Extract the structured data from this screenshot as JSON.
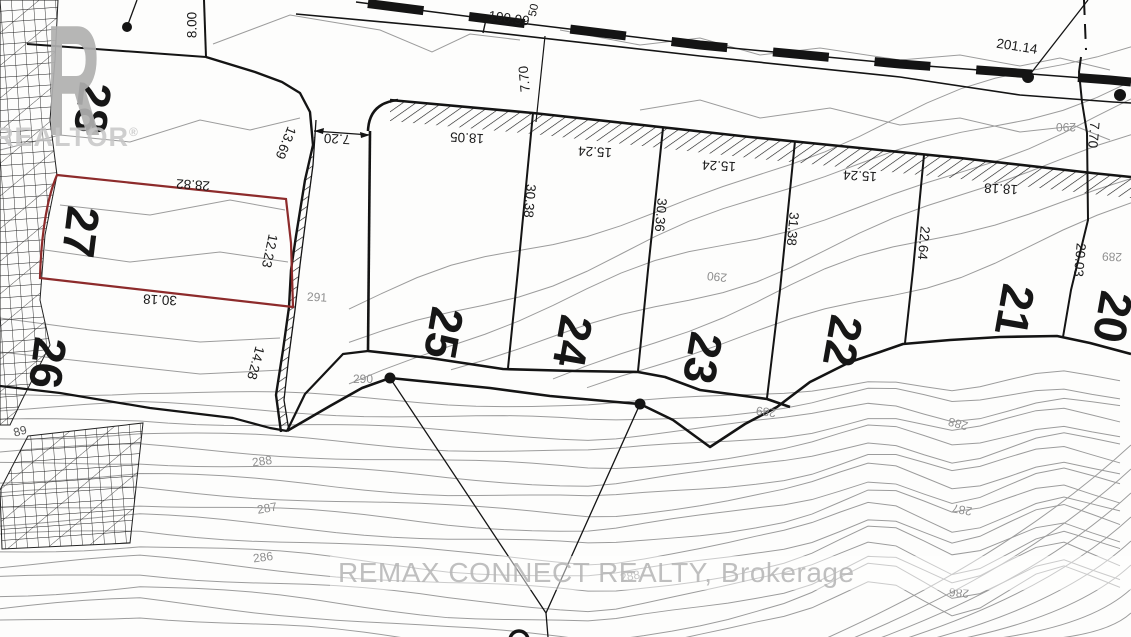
{
  "logo": {
    "letter": "R",
    "word": "REALTOR",
    "reg": "®"
  },
  "watermark": {
    "text": "REMAX CONNECT REALTY, Brokerage"
  },
  "map": {
    "lots": [
      {
        "number": "28",
        "x": 93,
        "y": 108,
        "rot": 97
      },
      {
        "number": "27",
        "x": 81,
        "y": 232,
        "rot": 97
      },
      {
        "number": "26",
        "x": 48,
        "y": 363,
        "rot": 97
      },
      {
        "number": "25",
        "x": 444,
        "y": 333,
        "rot": 100
      },
      {
        "number": "24",
        "x": 573,
        "y": 341,
        "rot": 100
      },
      {
        "number": "23",
        "x": 703,
        "y": 358,
        "rot": 100
      },
      {
        "number": "22",
        "x": 843,
        "y": 341,
        "rot": 100
      },
      {
        "number": "21",
        "x": 1015,
        "y": 310,
        "rot": 100
      },
      {
        "number": "20",
        "x": 1113,
        "y": 317,
        "rot": 100
      }
    ],
    "dimensions": [
      {
        "text": "8.00",
        "x": 192,
        "y": 25,
        "rot": -90
      },
      {
        "text": "190.99",
        "x": 509,
        "y": 18,
        "rot": 8
      },
      {
        "text": "50",
        "x": 533,
        "y": 10,
        "rot": -78,
        "small": true
      },
      {
        "text": "201.14",
        "x": 1017,
        "y": 46,
        "rot": 9
      },
      {
        "text": "7.70",
        "x": 524,
        "y": 79,
        "rot": -95
      },
      {
        "text": "7.70",
        "x": 1094,
        "y": 135,
        "rot": 95
      },
      {
        "text": "13.69",
        "x": 286,
        "y": 143,
        "rot": 112
      },
      {
        "text": "7.20",
        "x": 337,
        "y": 139,
        "rot": 183
      },
      {
        "text": "18.05",
        "x": 467,
        "y": 138,
        "rot": 183
      },
      {
        "text": "15.24",
        "x": 595,
        "y": 152,
        "rot": 183
      },
      {
        "text": "15.24",
        "x": 719,
        "y": 166,
        "rot": 183
      },
      {
        "text": "15.24",
        "x": 860,
        "y": 176,
        "rot": 183
      },
      {
        "text": "18.18",
        "x": 1001,
        "y": 189,
        "rot": 183
      },
      {
        "text": "28.82",
        "x": 193,
        "y": 185,
        "rot": 184
      },
      {
        "text": "12.23",
        "x": 270,
        "y": 251,
        "rot": 102
      },
      {
        "text": "30.18",
        "x": 160,
        "y": 300,
        "rot": 183
      },
      {
        "text": "14.28",
        "x": 256,
        "y": 363,
        "rot": 105
      },
      {
        "text": "30.38",
        "x": 530,
        "y": 201,
        "rot": 95
      },
      {
        "text": "30.36",
        "x": 661,
        "y": 215,
        "rot": 95
      },
      {
        "text": "31.38",
        "x": 793,
        "y": 229,
        "rot": 95
      },
      {
        "text": "22.64",
        "x": 924,
        "y": 243,
        "rot": 95
      },
      {
        "text": "20.03",
        "x": 1080,
        "y": 260,
        "rot": 95
      }
    ],
    "contour_elevations": [
      {
        "text": "291",
        "x": 317,
        "y": 297,
        "rot": 3
      },
      {
        "text": "290",
        "x": 363,
        "y": 379,
        "rot": 0
      },
      {
        "text": "290",
        "x": 717,
        "y": 277,
        "rot": 186
      },
      {
        "text": "290",
        "x": 1066,
        "y": 127,
        "rot": 180
      },
      {
        "text": "289",
        "x": 766,
        "y": 412,
        "rot": 188
      },
      {
        "text": "289",
        "x": 1112,
        "y": 257,
        "rot": 182
      },
      {
        "text": "288",
        "x": 958,
        "y": 424,
        "rot": 195
      },
      {
        "text": "287",
        "x": 962,
        "y": 510,
        "rot": 190
      },
      {
        "text": "286",
        "x": 959,
        "y": 593,
        "rot": 185
      },
      {
        "text": "288",
        "x": 262,
        "y": 461,
        "rot": -8
      },
      {
        "text": "287",
        "x": 267,
        "y": 508,
        "rot": -10
      },
      {
        "text": "286",
        "x": 263,
        "y": 557,
        "rot": -8
      },
      {
        "text": "288",
        "x": 630,
        "y": 576,
        "rot": -10
      },
      {
        "text": "89",
        "x": 20,
        "y": 431,
        "rot": -15,
        "dark": true
      }
    ],
    "survey_points": [
      {
        "x": 127,
        "y": 27,
        "r": 5
      },
      {
        "x": 1028,
        "y": 77,
        "r": 6
      },
      {
        "x": 1120,
        "y": 95,
        "r": 6
      },
      {
        "x": 390,
        "y": 378,
        "r": 5.5
      },
      {
        "x": 640,
        "y": 404,
        "r": 5.5
      }
    ],
    "colors": {
      "line": "#141414",
      "contour": "#9c9c9c",
      "highlight_red": "#8d2b2b",
      "label_gray": "#8f8f8f",
      "watermark": "#b5b5b5",
      "logo": "#b0b0b0"
    }
  }
}
